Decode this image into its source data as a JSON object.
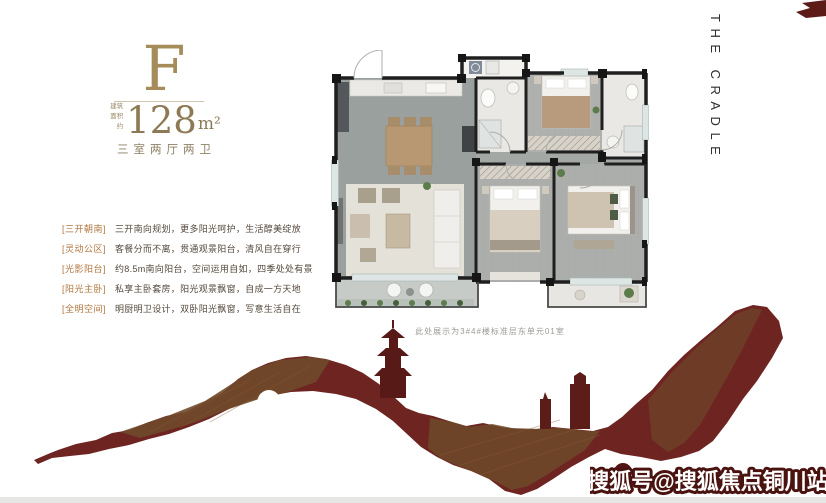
{
  "unit": {
    "type_label": "F",
    "area_prefix_lines": [
      "建筑",
      "面积约"
    ],
    "area_value": "128",
    "area_unit": "m²",
    "layout": "三室两厅两卫"
  },
  "features": [
    {
      "tag": "[三开朝南]",
      "desc": "三开南向规划，更多阳光呵护，生活醇美绽放"
    },
    {
      "tag": "[灵动公区]",
      "desc": "客餐分而不离，贯通观景阳台，清风自在穿行"
    },
    {
      "tag": "[光影阳台]",
      "desc": "约8.5m南向阳台，空间运用自如，四季处处有景"
    },
    {
      "tag": "[阳光主卧]",
      "desc": "私享主卧套房，阳光观景飘窗，自成一方天地"
    },
    {
      "tag": "[全明空间]",
      "desc": "明厨明卫设计，双卧阳光飘窗，写意生活自在"
    }
  ],
  "floor_plan": {
    "caption": "此处展示为3#4#楼标准层东单元01室"
  },
  "side_text": "THE CRADLE",
  "watermark": "搜狐号@搜狐焦点铜川站",
  "colors": {
    "gold": "#a58c58",
    "tag_orange": "#b1773f",
    "body_text": "#54493d",
    "wall_dark": "#1f1f1f",
    "art_red": "#6e2421",
    "art_brown": "#6f4a2a",
    "watermark_stroke": "#4a1310"
  }
}
